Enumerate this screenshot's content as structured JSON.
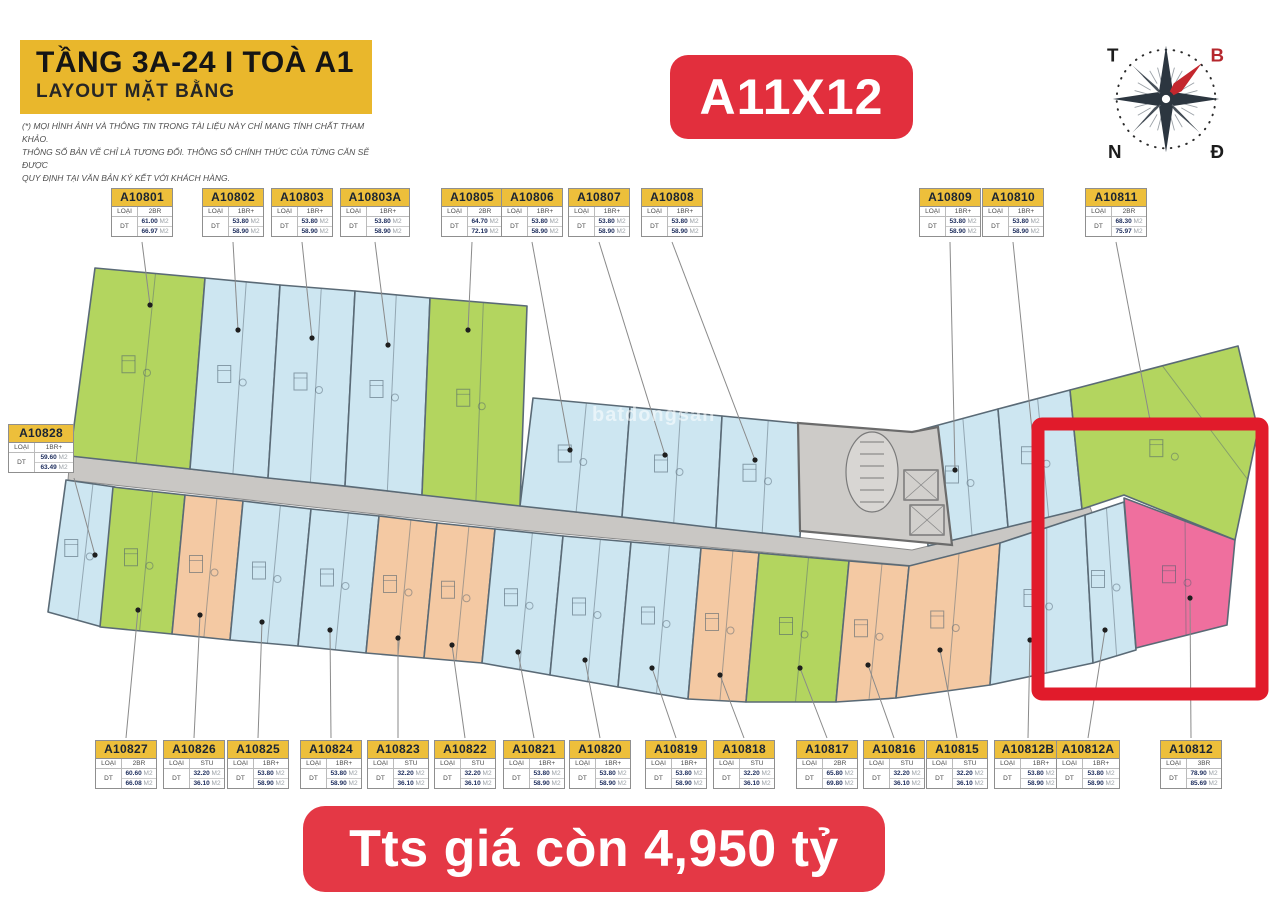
{
  "header": {
    "floor_title": "TẦNG 3A-24 I TOÀ A1",
    "subtitle": "LAYOUT MẶT BẰNG",
    "disclaimer1": "(*) MỌI HÌNH ẢNH VÀ THÔNG TIN TRONG TÀI LIỆU NÀY CHỈ MANG TÍNH CHẤT THAM KHẢO.",
    "disclaimer2": "THÔNG SỐ BẢN VẼ CHỈ LÀ TƯƠNG ĐỐI. THÔNG SỐ CHÍNH THỨC CỦA TỪNG CĂN SẼ ĐƯỢC",
    "disclaimer3": "QUY ĐỊNH TẠI VĂN BẢN KÝ KẾT VỚI KHÁCH HÀNG."
  },
  "tag": {
    "text": "A11X12"
  },
  "price": {
    "text": "Tts giá còn 4,950 tỷ"
  },
  "watermark": {
    "text": "batdongsan"
  },
  "compass": {
    "west": "T",
    "north": "B",
    "south": "N",
    "east": "Đ",
    "north_color": "#b5272d",
    "needle_color": "#c4272e",
    "rose_color": "#2c3640"
  },
  "label_fields": {
    "type_label": "LOẠI CH",
    "area_label": "DT",
    "area_unit": "M2"
  },
  "colors": {
    "banner_yellow": "#e9b72c",
    "header_yellow": "#edbf3b",
    "red": "#e22f3d",
    "highlight_red": "#e11b2b",
    "green": "#b3d55f",
    "blue": "#cde6f1",
    "peach": "#f4c9a3",
    "pink": "#ef6f9e",
    "corridor_gray": "#c9c7c4",
    "core_gray": "#cdcbc8",
    "wall": "#5a6a76",
    "number_navy": "#1c2c5c"
  },
  "plan": {
    "corridor": [
      [
        70,
        456
      ],
      [
        520,
        506
      ],
      [
        912,
        550
      ],
      [
        1090,
        507
      ],
      [
        1095,
        520
      ],
      [
        915,
        566
      ],
      [
        520,
        530
      ],
      [
        68,
        480
      ]
    ],
    "core": [
      [
        798,
        423
      ],
      [
        912,
        432
      ],
      [
        938,
        427
      ],
      [
        952,
        545
      ],
      [
        800,
        531
      ]
    ],
    "red_box": {
      "x": 1038,
      "y": 424,
      "w": 224,
      "h": 270
    },
    "units": [
      {
        "id": "A10801",
        "type": "2BR",
        "areas": [
          "61.00",
          "66.97"
        ],
        "color": "green",
        "label": {
          "row": "top",
          "x": 111,
          "w": 62,
          "cx": 142
        },
        "dot": [
          150,
          305
        ],
        "points": [
          [
            95,
            268
          ],
          [
            205,
            278
          ],
          [
            190,
            469
          ],
          [
            70,
            456
          ]
        ]
      },
      {
        "id": "A10802",
        "type": "1BR+",
        "areas": [
          "53.80",
          "58.90"
        ],
        "color": "blue",
        "label": {
          "row": "top",
          "x": 202,
          "w": 62,
          "cx": 233
        },
        "dot": [
          238,
          330
        ],
        "points": [
          [
            205,
            278
          ],
          [
            280,
            285
          ],
          [
            268,
            478
          ],
          [
            190,
            469
          ]
        ]
      },
      {
        "id": "A10803",
        "type": "1BR+",
        "areas": [
          "53.80",
          "58.90"
        ],
        "color": "blue",
        "label": {
          "row": "top",
          "x": 271,
          "w": 62,
          "cx": 302
        },
        "dot": [
          312,
          338
        ],
        "points": [
          [
            280,
            285
          ],
          [
            355,
            291
          ],
          [
            345,
            486
          ],
          [
            268,
            478
          ]
        ]
      },
      {
        "id": "A10803A",
        "type": "1BR+",
        "areas": [
          "53.80",
          "58.90"
        ],
        "color": "blue",
        "label": {
          "row": "top",
          "x": 340,
          "w": 70,
          "cx": 375
        },
        "dot": [
          388,
          345
        ],
        "points": [
          [
            355,
            291
          ],
          [
            430,
            298
          ],
          [
            422,
            495
          ],
          [
            345,
            486
          ]
        ]
      },
      {
        "id": "A10805",
        "type": "2BR",
        "areas": [
          "64.70",
          "72.19"
        ],
        "color": "green",
        "label": {
          "row": "top",
          "x": 441,
          "w": 62,
          "cx": 472
        },
        "dot": [
          468,
          330
        ],
        "points": [
          [
            430,
            298
          ],
          [
            527,
            306
          ],
          [
            520,
            506
          ],
          [
            422,
            495
          ]
        ]
      },
      {
        "id": "A10806",
        "type": "1BR+",
        "areas": [
          "53.80",
          "58.90"
        ],
        "color": "blue",
        "label": {
          "row": "top",
          "x": 501,
          "w": 62,
          "cx": 532
        },
        "dot": [
          570,
          450
        ],
        "points": [
          [
            533,
            398
          ],
          [
            630,
            407
          ],
          [
            622,
            517
          ],
          [
            520,
            506
          ]
        ]
      },
      {
        "id": "A10807",
        "type": "1BR+",
        "areas": [
          "53.80",
          "58.90"
        ],
        "color": "blue",
        "label": {
          "row": "top",
          "x": 568,
          "w": 62,
          "cx": 599
        },
        "dot": [
          665,
          455
        ],
        "points": [
          [
            630,
            407
          ],
          [
            722,
            416
          ],
          [
            716,
            528
          ],
          [
            622,
            517
          ]
        ]
      },
      {
        "id": "A10808",
        "type": "1BR+",
        "areas": [
          "53.80",
          "58.90"
        ],
        "color": "blue",
        "label": {
          "row": "top",
          "x": 641,
          "w": 62,
          "cx": 672
        },
        "dot": [
          755,
          460
        ],
        "points": [
          [
            722,
            416
          ],
          [
            806,
            424
          ],
          [
            800,
            537
          ],
          [
            716,
            528
          ]
        ]
      },
      {
        "id": "A10809",
        "type": "1BR+",
        "areas": [
          "53.80",
          "58.90"
        ],
        "color": "blue",
        "label": {
          "row": "top",
          "x": 919,
          "w": 62,
          "cx": 950
        },
        "dot": [
          955,
          470
        ],
        "points": [
          [
            920,
            430
          ],
          [
            998,
            409
          ],
          [
            1008,
            527
          ],
          [
            928,
            546
          ]
        ]
      },
      {
        "id": "A10810",
        "type": "1BR+",
        "areas": [
          "53.80",
          "58.90"
        ],
        "color": "blue",
        "label": {
          "row": "top",
          "x": 982,
          "w": 62,
          "cx": 1013
        },
        "dot": [
          1035,
          460
        ],
        "points": [
          [
            998,
            409
          ],
          [
            1070,
            390
          ],
          [
            1082,
            509
          ],
          [
            1008,
            527
          ]
        ]
      },
      {
        "id": "A10811",
        "type": "2BR",
        "areas": [
          "68.30",
          "75.97"
        ],
        "color": "green",
        "label": {
          "row": "top",
          "x": 1085,
          "w": 62,
          "cx": 1116
        },
        "dot": [
          1150,
          420
        ],
        "points": [
          [
            1070,
            390
          ],
          [
            1238,
            346
          ],
          [
            1258,
            430
          ],
          [
            1235,
            540
          ],
          [
            1124,
            495
          ],
          [
            1082,
            509
          ]
        ]
      },
      {
        "id": "A10828",
        "type": "1BR+",
        "areas": [
          "59.60",
          "63.49"
        ],
        "color": "blue",
        "label": {
          "row": "left",
          "x": 8,
          "w": 66,
          "cx": 41
        },
        "dot": [
          95,
          555
        ],
        "points": [
          [
            66,
            480
          ],
          [
            115,
            487
          ],
          [
            102,
            627
          ],
          [
            48,
            612
          ]
        ]
      },
      {
        "id": "A10827",
        "type": "2BR",
        "areas": [
          "60.60",
          "66.08"
        ],
        "color": "green",
        "label": {
          "row": "bottom",
          "x": 95,
          "w": 62,
          "cx": 126
        },
        "dot": [
          138,
          610
        ],
        "points": [
          [
            113,
            487
          ],
          [
            185,
            495
          ],
          [
            172,
            634
          ],
          [
            100,
            627
          ]
        ]
      },
      {
        "id": "A10826",
        "type": "STU",
        "areas": [
          "32.20",
          "36.10"
        ],
        "color": "peach",
        "label": {
          "row": "bottom",
          "x": 163,
          "w": 62,
          "cx": 194
        },
        "dot": [
          200,
          615
        ],
        "points": [
          [
            185,
            495
          ],
          [
            243,
            501
          ],
          [
            230,
            640
          ],
          [
            172,
            634
          ]
        ]
      },
      {
        "id": "A10825",
        "type": "1BR+",
        "areas": [
          "53.80",
          "58.90"
        ],
        "color": "blue",
        "label": {
          "row": "bottom",
          "x": 227,
          "w": 62,
          "cx": 258
        },
        "dot": [
          262,
          622
        ],
        "points": [
          [
            243,
            501
          ],
          [
            311,
            509
          ],
          [
            298,
            646
          ],
          [
            230,
            640
          ]
        ]
      },
      {
        "id": "A10824",
        "type": "1BR+",
        "areas": [
          "53.80",
          "58.90"
        ],
        "color": "blue",
        "label": {
          "row": "bottom",
          "x": 300,
          "w": 62,
          "cx": 331
        },
        "dot": [
          330,
          630
        ],
        "points": [
          [
            311,
            509
          ],
          [
            379,
            516
          ],
          [
            366,
            653
          ],
          [
            298,
            646
          ]
        ]
      },
      {
        "id": "A10823",
        "type": "STU",
        "areas": [
          "32.20",
          "36.10"
        ],
        "color": "peach",
        "label": {
          "row": "bottom",
          "x": 367,
          "w": 62,
          "cx": 398
        },
        "dot": [
          398,
          638
        ],
        "points": [
          [
            379,
            516
          ],
          [
            437,
            523
          ],
          [
            424,
            658
          ],
          [
            366,
            653
          ]
        ]
      },
      {
        "id": "A10822",
        "type": "STU",
        "areas": [
          "32.20",
          "36.10"
        ],
        "color": "peach",
        "label": {
          "row": "bottom",
          "x": 434,
          "w": 62,
          "cx": 465
        },
        "dot": [
          452,
          645
        ],
        "points": [
          [
            437,
            523
          ],
          [
            495,
            529
          ],
          [
            482,
            663
          ],
          [
            424,
            658
          ]
        ]
      },
      {
        "id": "A10821",
        "type": "1BR+",
        "areas": [
          "53.80",
          "58.90"
        ],
        "color": "blue",
        "label": {
          "row": "bottom",
          "x": 503,
          "w": 62,
          "cx": 534
        },
        "dot": [
          518,
          652
        ],
        "points": [
          [
            495,
            529
          ],
          [
            563,
            536
          ],
          [
            550,
            675
          ],
          [
            482,
            663
          ]
        ]
      },
      {
        "id": "A10820",
        "type": "1BR+",
        "areas": [
          "53.80",
          "58.90"
        ],
        "color": "blue",
        "label": {
          "row": "bottom",
          "x": 569,
          "w": 62,
          "cx": 600
        },
        "dot": [
          585,
          660
        ],
        "points": [
          [
            563,
            536
          ],
          [
            631,
            542
          ],
          [
            618,
            687
          ],
          [
            550,
            675
          ]
        ]
      },
      {
        "id": "A10819",
        "type": "1BR+",
        "areas": [
          "53.80",
          "58.90"
        ],
        "color": "blue",
        "label": {
          "row": "bottom",
          "x": 645,
          "w": 62,
          "cx": 676
        },
        "dot": [
          652,
          668
        ],
        "points": [
          [
            631,
            542
          ],
          [
            701,
            548
          ],
          [
            688,
            699
          ],
          [
            618,
            687
          ]
        ]
      },
      {
        "id": "A10818",
        "type": "STU",
        "areas": [
          "32.20",
          "36.10"
        ],
        "color": "peach",
        "label": {
          "row": "bottom",
          "x": 713,
          "w": 62,
          "cx": 744
        },
        "dot": [
          720,
          675
        ],
        "points": [
          [
            701,
            548
          ],
          [
            759,
            553
          ],
          [
            746,
            702
          ],
          [
            688,
            699
          ]
        ]
      },
      {
        "id": "A10817",
        "type": "2BR",
        "areas": [
          "65.80",
          "69.80"
        ],
        "color": "green",
        "label": {
          "row": "bottom",
          "x": 796,
          "w": 62,
          "cx": 827
        },
        "dot": [
          800,
          668
        ],
        "points": [
          [
            759,
            553
          ],
          [
            849,
            561
          ],
          [
            836,
            702
          ],
          [
            746,
            702
          ]
        ]
      },
      {
        "id": "A10816",
        "type": "STU",
        "areas": [
          "32.20",
          "36.10"
        ],
        "color": "peach",
        "label": {
          "row": "bottom",
          "x": 863,
          "w": 62,
          "cx": 894
        },
        "dot": [
          868,
          665
        ],
        "points": [
          [
            849,
            561
          ],
          [
            909,
            566
          ],
          [
            896,
            698
          ],
          [
            836,
            702
          ]
        ]
      },
      {
        "id": "A10815",
        "type": "STU",
        "areas": [
          "32.20",
          "36.10"
        ],
        "color": "peach",
        "label": {
          "row": "bottom",
          "x": 926,
          "w": 62,
          "cx": 957
        },
        "dot": [
          940,
          650
        ],
        "points": [
          [
            909,
            566
          ],
          [
            1000,
            543
          ],
          [
            990,
            685
          ],
          [
            896,
            698
          ]
        ]
      },
      {
        "id": "A10812B",
        "type": "1BR+",
        "areas": [
          "53.80",
          "58.90"
        ],
        "color": "blue",
        "label": {
          "row": "bottom",
          "x": 994,
          "w": 68,
          "cx": 1028
        },
        "dot": [
          1030,
          640
        ],
        "points": [
          [
            1000,
            543
          ],
          [
            1085,
            515
          ],
          [
            1093,
            663
          ],
          [
            990,
            685
          ]
        ]
      },
      {
        "id": "A10812A",
        "type": "1BR+",
        "areas": [
          "53.80",
          "58.90"
        ],
        "color": "blue",
        "label": {
          "row": "bottom",
          "x": 1056,
          "w": 64,
          "cx": 1088
        },
        "dot": [
          1105,
          630
        ],
        "points": [
          [
            1085,
            515
          ],
          [
            1124,
            502
          ],
          [
            1136,
            650
          ],
          [
            1093,
            663
          ]
        ]
      },
      {
        "id": "A10812",
        "type": "3BR",
        "areas": [
          "78.90",
          "85.69"
        ],
        "color": "pink",
        "label": {
          "row": "bottom",
          "x": 1160,
          "w": 62,
          "cx": 1191
        },
        "dot": [
          1190,
          598
        ],
        "points": [
          [
            1124,
            498
          ],
          [
            1235,
            540
          ],
          [
            1227,
            625
          ],
          [
            1136,
            648
          ]
        ]
      }
    ]
  }
}
